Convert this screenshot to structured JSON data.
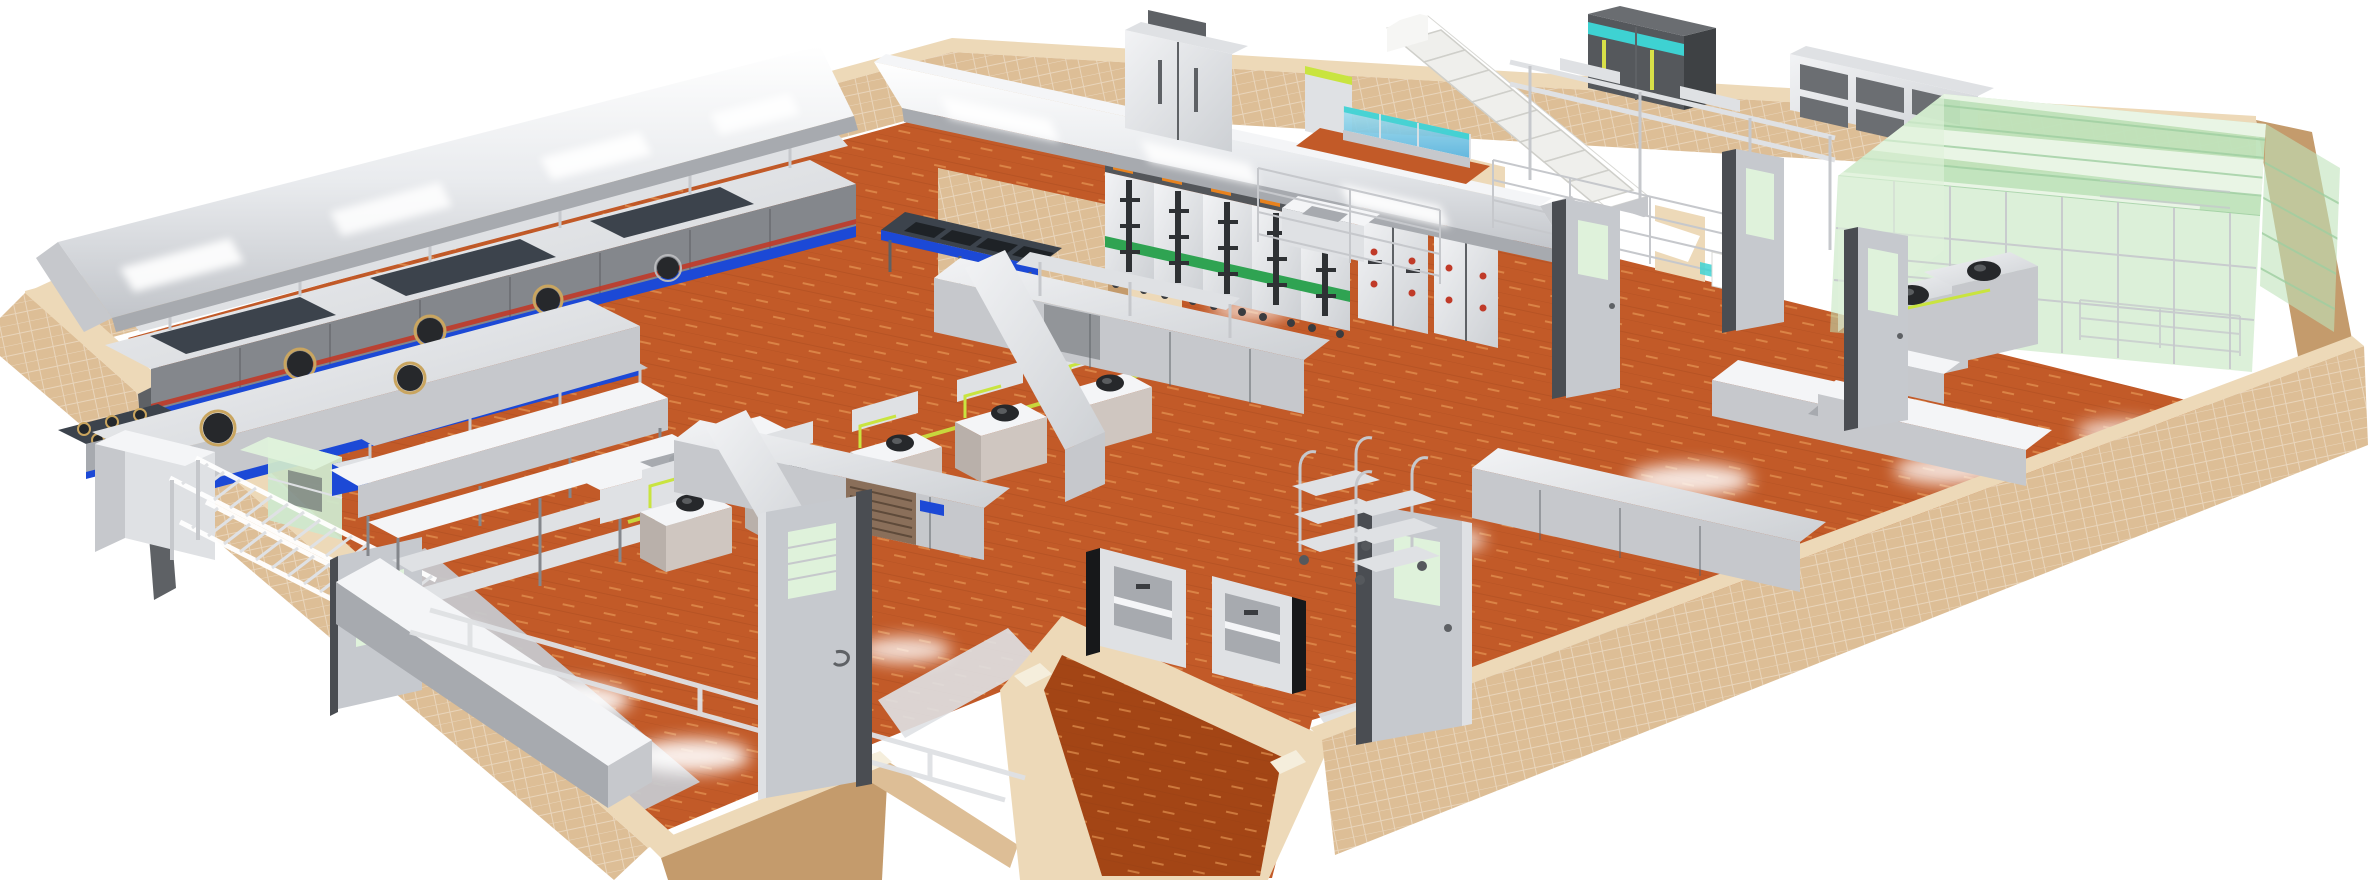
{
  "meta": {
    "title": "3D isometric cutaway rendering of a commercial kitchen layout",
    "view": "perspective cutaway, half-height tiled walls, white background",
    "canvas": {
      "width": 2368,
      "height": 880
    }
  },
  "palette": {
    "floor_orange": "#C25A28",
    "floor_orange_dark": "#A34515",
    "floor_dash": "#EFA35F",
    "wall_tan": "#DDBE96",
    "wall_tan_light": "#EDD9B8",
    "wall_tan_dark": "#C49B6C",
    "wall_trim": "#F5EEDC",
    "steel_bright": "#F4F5F7",
    "steel_light": "#DFE1E4",
    "steel_mid": "#C6C8CC",
    "steel_shade": "#A7AAAF",
    "steel_dark": "#84878C",
    "steel_darker": "#5E6165",
    "equip_charcoal": "#3C434C",
    "accent_blue": "#1C49D6",
    "accent_red": "#C03A28",
    "teal": "#3ED2D2",
    "water_blue": "#69C4E2",
    "glass_green_pale": "#DFF2DB",
    "glass_green": "#BFE3BA",
    "glass_green_deep": "#8FC492",
    "sage": "#CFE8CC",
    "gas_yellow": "#C9E43F",
    "wok_black": "#26282B",
    "steamer_green": "#2FA352",
    "steamer_orange": "#E8821E",
    "door_gray": "#C6C9CE",
    "frame_dark": "#4A4D52",
    "background": "#FFFFFF"
  },
  "inventory": [
    {
      "id": "exhaust-hood-west",
      "label": "long wall-mounted exhaust hood with lights"
    },
    {
      "id": "cooking-line-west",
      "label": "wok and burner cooking line with blue kick stripe"
    },
    {
      "id": "six-burner-range",
      "label": "six-burner gas range"
    },
    {
      "id": "wok-island",
      "label": "front wok island with sunken woks"
    },
    {
      "id": "sage-glass-cabinet",
      "label": "pale green glass pass cabinet"
    },
    {
      "id": "pot-ladder-rack",
      "label": "two-tier tubular pot rack"
    },
    {
      "id": "wok-station-row",
      "label": "five wok stations with gas piping and black woks"
    },
    {
      "id": "stockpot-burners",
      "label": "stock-pot burner stand"
    },
    {
      "id": "island-hood-center",
      "label": "central island exhaust hood"
    },
    {
      "id": "rice-steamer-cabinets",
      "label": "rice steamer cabinets with green stripe and casters"
    },
    {
      "id": "steam-oven-cabinets",
      "label": "double-door steam cabinets with red indicator knobs"
    },
    {
      "id": "upright-fridge",
      "label": "two-door upright refrigerator"
    },
    {
      "id": "staircase",
      "label": "white staircase to upper floor"
    },
    {
      "id": "fish-tanks",
      "label": "glass fish tanks with blue water"
    },
    {
      "id": "freezer-units",
      "label": "dark freezers with teal header"
    },
    {
      "id": "wall-cabinets",
      "label": "stainless open wall cabinets"
    },
    {
      "id": "overhead-rails",
      "label": "overhead stainless rail shelving"
    },
    {
      "id": "wire-shelving",
      "label": "chrome wire shelving racks"
    },
    {
      "id": "l-shaped-counters",
      "label": "L-shaped worktop counters with sliding-door bases"
    },
    {
      "id": "prep-tables",
      "label": "stainless prep tables with undershelves and overshelves"
    },
    {
      "id": "refrigerated-counter",
      "label": "refrigerated counter with vent grille"
    },
    {
      "id": "glass-cold-room",
      "label": "green glass enclosed cold/display room with striped roof"
    },
    {
      "id": "front-wok-units",
      "label": "wok units with black pots beside glass room"
    },
    {
      "id": "dumbwaiters",
      "label": "two wall-mounted dumbwaiter lifts"
    },
    {
      "id": "service-trolleys",
      "label": "three-tier service trolleys"
    },
    {
      "id": "doors",
      "label": "gray metal doors with vision panels"
    },
    {
      "id": "perimeter-walls",
      "label": "tan tiled half-height walls"
    },
    {
      "id": "floor",
      "label": "terracotta tiled floor with drainage walkways"
    }
  ]
}
